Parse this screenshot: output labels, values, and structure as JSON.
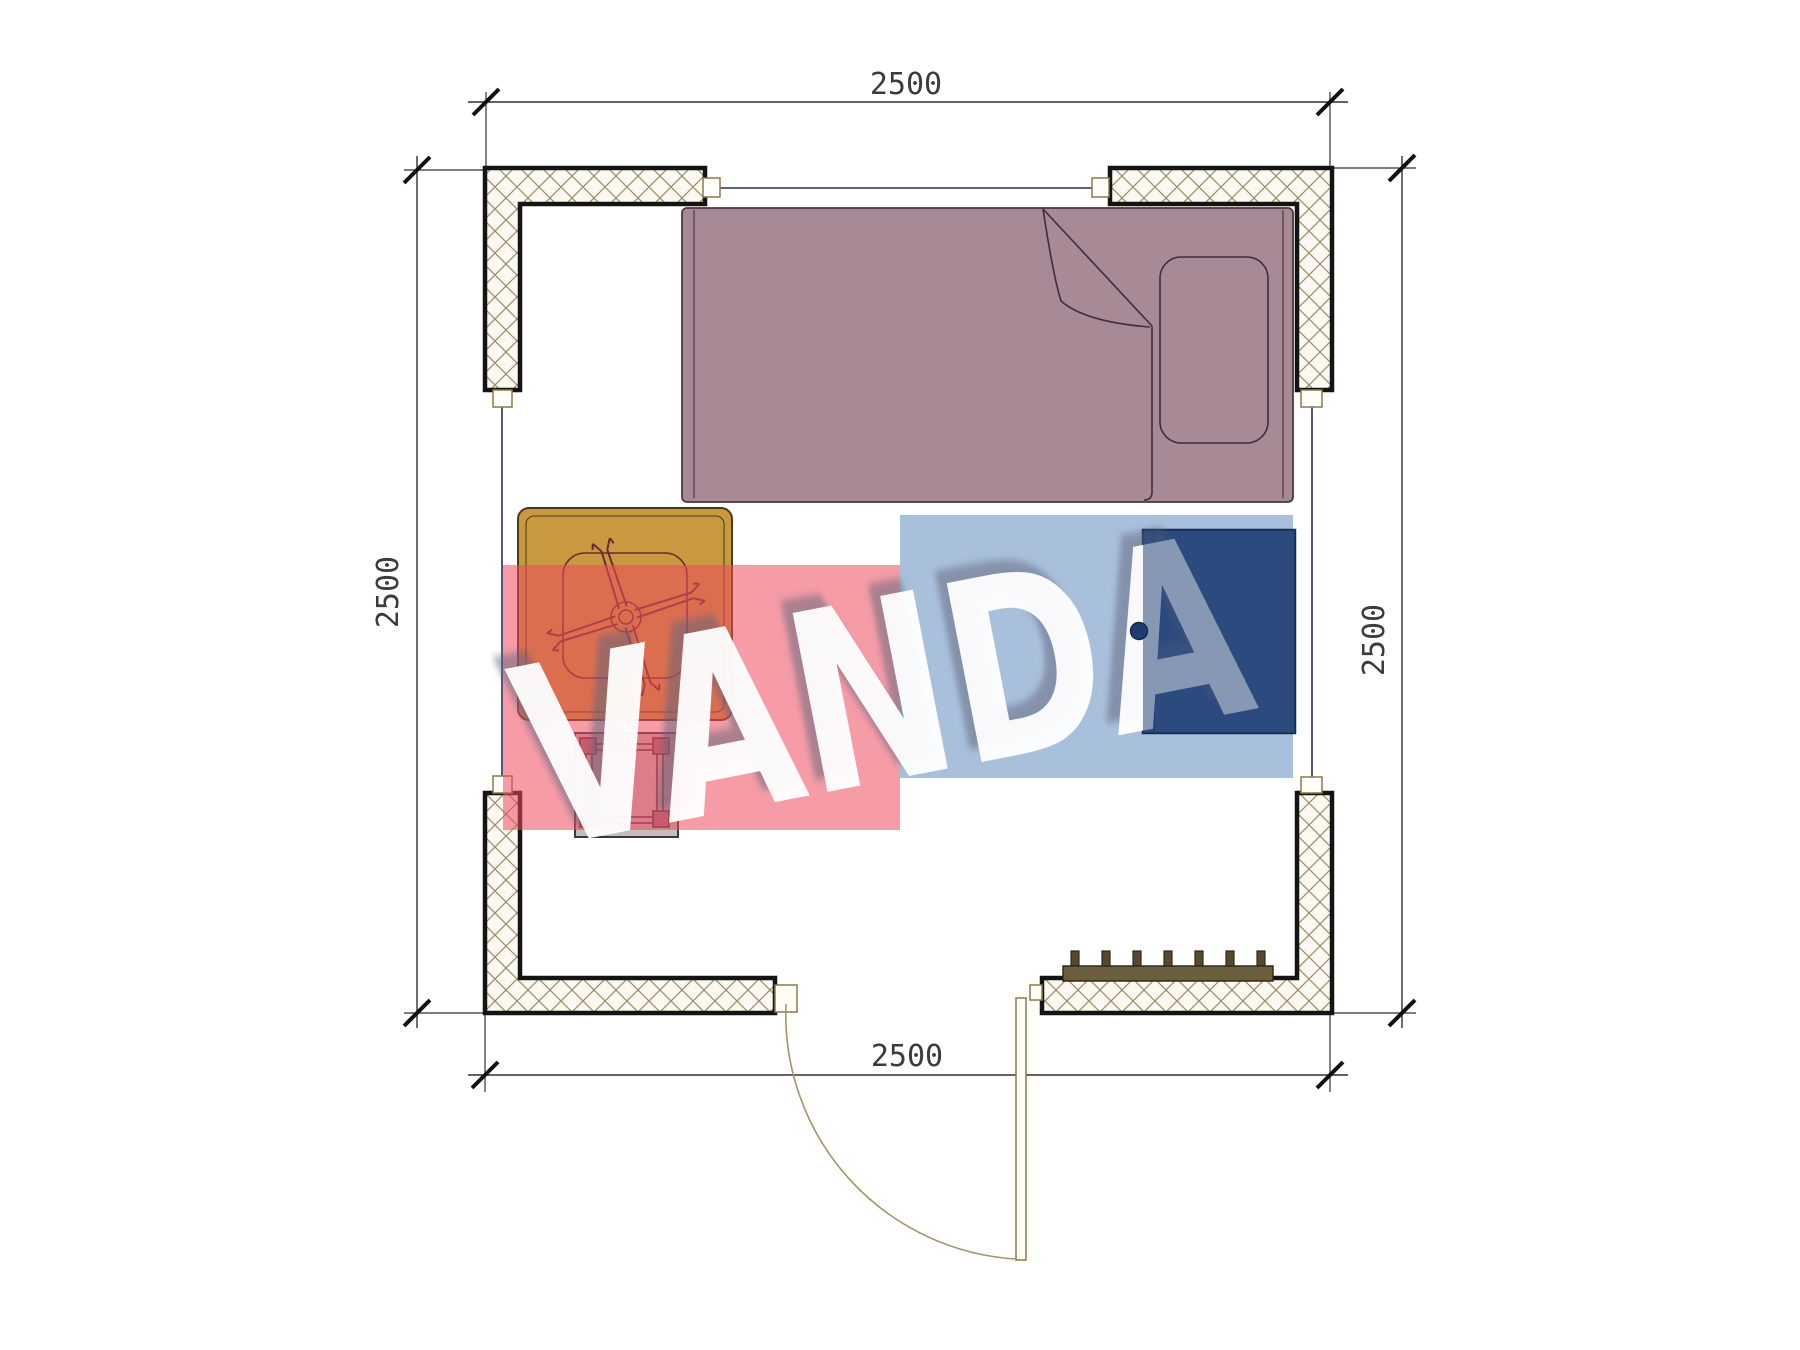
{
  "dimensions": {
    "top": {
      "label": "2500"
    },
    "bottom": {
      "label": "2500"
    },
    "left": {
      "label": "2500"
    },
    "right": {
      "label": "2500"
    }
  },
  "watermark": {
    "text": "VANDA",
    "pink_color": "#ED4B5F",
    "blue_color": "#8CABD0"
  },
  "colors": {
    "bed": "#a78a95",
    "table": "#c8993f",
    "cabinet": "#2c4a7e",
    "stool": "#beb2b2",
    "bench": "#6b5e3e",
    "door": "#a5946a"
  }
}
